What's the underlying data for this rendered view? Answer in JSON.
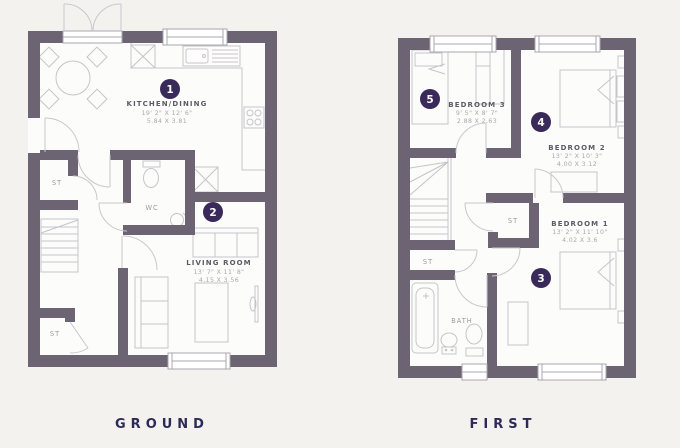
{
  "colors": {
    "background": "#f3f2ef",
    "floor": "#fcfcfa",
    "wall": "#6c6472",
    "marker": "#392a5a",
    "accent_text": "#2e2a58"
  },
  "floors": {
    "ground": {
      "label": "GROUND",
      "rooms": {
        "kitchen": {
          "marker": "1",
          "name": "KITCHEN/DINING",
          "imperial": "19' 2\" X 12' 6\"",
          "metric": "5.84 X 3.81"
        },
        "living": {
          "marker": "2",
          "name": "LIVING ROOM",
          "imperial": "13' 7\" X 11' 8\"",
          "metric": "4.15 X 3.56"
        },
        "wc": {
          "name": "WC"
        },
        "st_hall": {
          "name": "ST"
        },
        "st_lower": {
          "name": "ST"
        }
      }
    },
    "first": {
      "label": "FIRST",
      "rooms": {
        "bedroom3": {
          "marker": "5",
          "name": "BEDROOM 3",
          "imperial": "9' 5\" X 8' 7\"",
          "metric": "2.88 X 2.63"
        },
        "bedroom2": {
          "marker": "4",
          "name": "BEDROOM 2",
          "imperial": "13' 2\" X 10' 3\"",
          "metric": "4.00 X 3.12"
        },
        "bedroom1": {
          "marker": "3",
          "name": "BEDROOM 1",
          "imperial": "13' 2\" X 11' 10\"",
          "metric": "4.02 X 3.6"
        },
        "bath": {
          "name": "BATH"
        },
        "st_landing": {
          "name": "ST"
        },
        "st_stairs": {
          "name": "ST"
        }
      }
    }
  }
}
